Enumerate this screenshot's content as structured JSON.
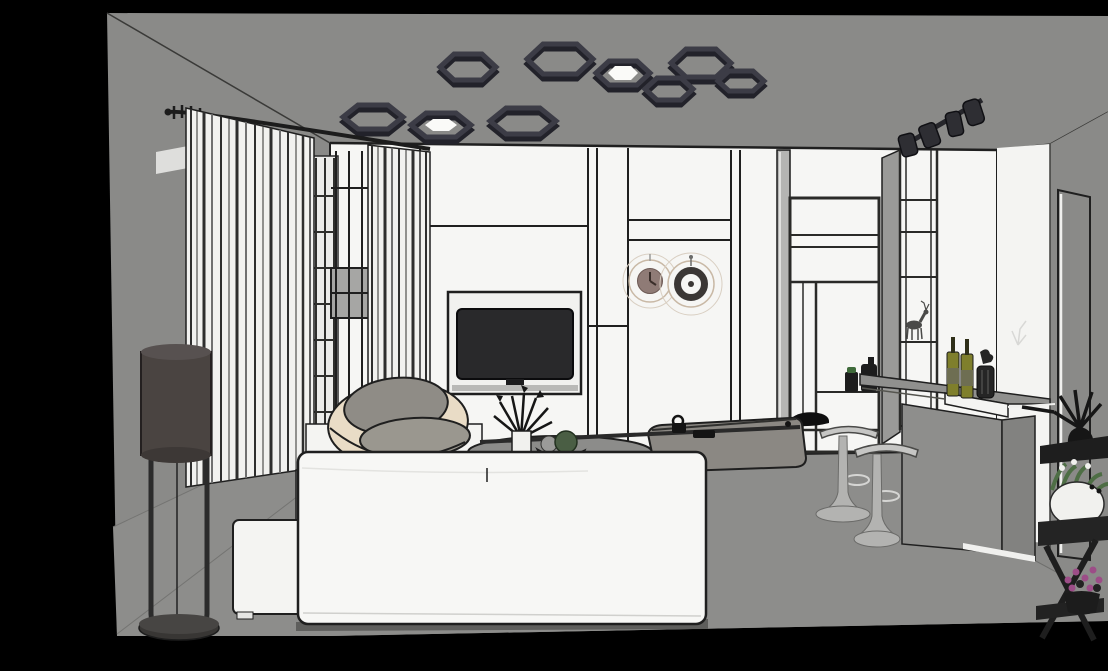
{
  "canvas": {
    "width": 1108,
    "height": 671,
    "background": "#000000"
  },
  "scene": {
    "type": "3d-interior-render",
    "description": "Monochrome SketchUp-style render of a living room: hexagonal ceiling lights, striped curtains, white TV panel wall with two wall clocks, round accent chair, white sofa, bar counter with wine bottles and two pedestal stools, wardrobe shelving, doorway, dark wall shelves and potted plants",
    "objects": [
      "hex-ceiling-lights",
      "track-spotlights",
      "curtains",
      "curtain-rod",
      "slat-screen",
      "tv-wall",
      "tv",
      "wall-clock-solid",
      "wall-clock-ring",
      "wardrobe-shelving",
      "display-column",
      "deer-figurine",
      "storage-jars",
      "floor-lamp",
      "accent-chair",
      "ottoman",
      "tv-bench",
      "sofa",
      "chaise-cushion",
      "coffee-table",
      "branch-decor",
      "fruit-bowl",
      "bar-counter",
      "wine-bottles",
      "candle-lantern",
      "bar-stools",
      "doorway",
      "door-frame",
      "wall-shelf-dark",
      "black-branch-plant",
      "white-potted-plant",
      "plant-stand",
      "pink-flower-pot"
    ]
  },
  "colors": {
    "background": "#000000",
    "room_gray": "#8a8a88",
    "floor_gray": "#8d8d8b",
    "wall_white": "#f6f6f4",
    "doorway_white": "#f4f4f2",
    "line_dark": "#1f1f1f",
    "panel_inset": "#f1f1ef",
    "niche_shadow": "#b9b9b7",
    "tv_screen": "#29292b",
    "hex_frame": "#3c3c46",
    "hex_frame_dark": "#22222a",
    "hex_inner": "#fafaf8",
    "spot_body": "#2e2e33",
    "curtain_white": "#f1f1ef",
    "curtain_fold": "#2e2e2e",
    "screen_band": "#a6a6a4",
    "clock_rim": "#c9b9a6",
    "clock_face": "#8f7b76",
    "clock_ring": "#3b3735",
    "lamp_shade": "#4a4441",
    "lamp_metal": "#2b2b2b",
    "chair_shell": "#e9dcc6",
    "chair_back": "#8f8c86",
    "chair_seat": "#9a978f",
    "bench_white": "#f4f4f2",
    "sofa_white": "#f7f7f5",
    "chaise_gray": "#8b8883",
    "table_gray": "#8c8c8a",
    "bowl_tan": "#bf9d72",
    "ball_gray": "#9b9b99",
    "ball_green": "#4a5e44",
    "counter_gray": "#90908e",
    "counter_face": "#8e8e8c",
    "fascia_white": "#f4f4f2",
    "bottle_olive": "#7f7f2c",
    "bottle_label": "#6e6e52",
    "stool_metal": "#b3b3b1",
    "stool_seat": "#c6c6c4",
    "shelf_dark": "#1e1e1e",
    "plant_black": "#161616",
    "pot_white": "#f1f1ee",
    "leaf_green": "#4e6e45",
    "flower_pink": "#9c4d87",
    "unit_side": "#9a9a98",
    "mirror_gray": "#b5b5b3",
    "deer_gray": "#4a4a48",
    "shadow_gray": "#5e5e5c"
  }
}
